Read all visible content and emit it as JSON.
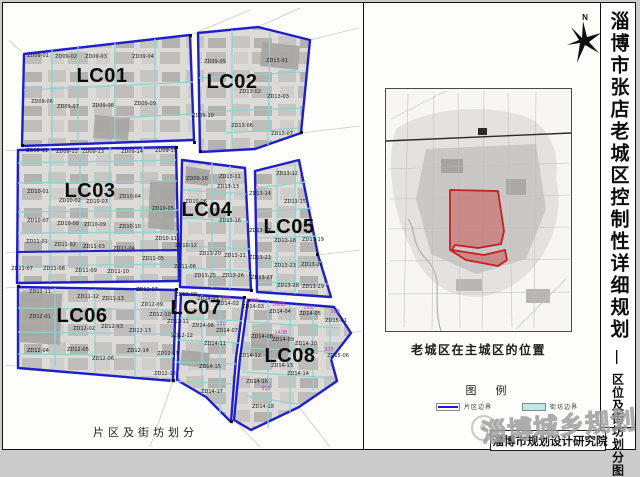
{
  "page": {
    "title_main": "淄博市张店老城区控制性详细规划",
    "title_separator": "—",
    "title_sub": "区位及街坊划分图"
  },
  "north": {
    "label": "N"
  },
  "map_panel": {
    "caption": "片区及街坊划分"
  },
  "locator": {
    "caption": "老城区在主城区的位置"
  },
  "legend": {
    "title": "图 例",
    "items": [
      {
        "label": "片区边界",
        "color": "#2222bb",
        "style": "line"
      },
      {
        "label": "街坊边界",
        "color": "#bfe6e8",
        "style": "fill"
      }
    ]
  },
  "footer": {
    "watermark": "淄博城乡规划",
    "institute": "淄博市规划设计研究院"
  },
  "colors": {
    "district_boundary": "#1f1fc8",
    "block_boundary": "#8fd2d2",
    "parcel_gray": "#c3c2bf",
    "highlight_red": "#c51f1f",
    "plot_code_magenta": "#c438c4",
    "logo_blue": "#2b3f9e"
  },
  "map": {
    "district_labels": [
      {
        "t": "LC01",
        "x": 102,
        "y": 82
      },
      {
        "t": "LC02",
        "x": 232,
        "y": 88
      },
      {
        "t": "LC03",
        "x": 90,
        "y": 197
      },
      {
        "t": "LC04",
        "x": 207,
        "y": 216
      },
      {
        "t": "LC05",
        "x": 289,
        "y": 233
      },
      {
        "t": "LC06",
        "x": 82,
        "y": 322
      },
      {
        "t": "LC07",
        "x": 196,
        "y": 314
      },
      {
        "t": "LC08",
        "x": 290,
        "y": 362
      }
    ],
    "block_labels": [
      {
        "t": "ZD09-01",
        "x": 38,
        "y": 57
      },
      {
        "t": "ZD09-02",
        "x": 66,
        "y": 58
      },
      {
        "t": "ZD09-03",
        "x": 96,
        "y": 58
      },
      {
        "t": "ZD09-04",
        "x": 143,
        "y": 58
      },
      {
        "t": "ZD09-06",
        "x": 42,
        "y": 103
      },
      {
        "t": "ZD09-07",
        "x": 68,
        "y": 108
      },
      {
        "t": "ZD09-08",
        "x": 103,
        "y": 107
      },
      {
        "t": "ZD09-09",
        "x": 145,
        "y": 105
      },
      {
        "t": "ZD09-05",
        "x": 215,
        "y": 63
      },
      {
        "t": "ZD13-01",
        "x": 277,
        "y": 62
      },
      {
        "t": "ZD13-02",
        "x": 250,
        "y": 93
      },
      {
        "t": "ZD13-03",
        "x": 278,
        "y": 98
      },
      {
        "t": "ZD09-10",
        "x": 203,
        "y": 117
      },
      {
        "t": "ZD13-06",
        "x": 242,
        "y": 127
      },
      {
        "t": "ZD13-07",
        "x": 282,
        "y": 135
      },
      {
        "t": "ZD09-11",
        "x": 37,
        "y": 152
      },
      {
        "t": "ZD09-12",
        "x": 67,
        "y": 153
      },
      {
        "t": "ZD09-13",
        "x": 93,
        "y": 153
      },
      {
        "t": "ZD09-14",
        "x": 132,
        "y": 153
      },
      {
        "t": "ZD09-15",
        "x": 166,
        "y": 152
      },
      {
        "t": "ZD09-16",
        "x": 197,
        "y": 180
      },
      {
        "t": "ZD10-01",
        "x": 38,
        "y": 193
      },
      {
        "t": "ZD10-02",
        "x": 70,
        "y": 202
      },
      {
        "t": "ZD10-03",
        "x": 97,
        "y": 203
      },
      {
        "t": "ZD10-04",
        "x": 130,
        "y": 198
      },
      {
        "t": "ZD10-05",
        "x": 163,
        "y": 210
      },
      {
        "t": "ZD10-06",
        "x": 196,
        "y": 203
      },
      {
        "t": "ZD10-07",
        "x": 38,
        "y": 222
      },
      {
        "t": "ZD10-08",
        "x": 68,
        "y": 225
      },
      {
        "t": "ZD10-09",
        "x": 95,
        "y": 226
      },
      {
        "t": "ZD10-10",
        "x": 130,
        "y": 228
      },
      {
        "t": "ZD10-11",
        "x": 166,
        "y": 240
      },
      {
        "t": "ZD10-12",
        "x": 186,
        "y": 247
      },
      {
        "t": "ZD11-01",
        "x": 37,
        "y": 243
      },
      {
        "t": "ZD11-02",
        "x": 65,
        "y": 246
      },
      {
        "t": "ZD11-03",
        "x": 94,
        "y": 248
      },
      {
        "t": "ZD11-04",
        "x": 124,
        "y": 250
      },
      {
        "t": "ZD11-05",
        "x": 153,
        "y": 260
      },
      {
        "t": "ZD11-06",
        "x": 185,
        "y": 268
      },
      {
        "t": "ZD11-07",
        "x": 22,
        "y": 270
      },
      {
        "t": "ZD11-08",
        "x": 54,
        "y": 270
      },
      {
        "t": "ZD11-09",
        "x": 86,
        "y": 272
      },
      {
        "t": "ZD11-10",
        "x": 118,
        "y": 273
      },
      {
        "t": "ZD13-11",
        "x": 230,
        "y": 178
      },
      {
        "t": "ZD13-12",
        "x": 287,
        "y": 175
      },
      {
        "t": "ZD13-13",
        "x": 228,
        "y": 188
      },
      {
        "t": "ZD13-14",
        "x": 260,
        "y": 195
      },
      {
        "t": "ZD13-15",
        "x": 295,
        "y": 203
      },
      {
        "t": "ZD13-16",
        "x": 230,
        "y": 222
      },
      {
        "t": "ZD13-17",
        "x": 260,
        "y": 232
      },
      {
        "t": "ZD13-18",
        "x": 285,
        "y": 242
      },
      {
        "t": "ZD13-19",
        "x": 313,
        "y": 241
      },
      {
        "t": "ZD13-20",
        "x": 210,
        "y": 255
      },
      {
        "t": "ZD13-21",
        "x": 235,
        "y": 257
      },
      {
        "t": "ZD13-22",
        "x": 260,
        "y": 259
      },
      {
        "t": "ZD13-23",
        "x": 285,
        "y": 267
      },
      {
        "t": "ZD13-24",
        "x": 312,
        "y": 266
      },
      {
        "t": "ZD13-25",
        "x": 205,
        "y": 277
      },
      {
        "t": "ZD13-26",
        "x": 233,
        "y": 277
      },
      {
        "t": "ZD13-27",
        "x": 262,
        "y": 279
      },
      {
        "t": "ZD13-28",
        "x": 288,
        "y": 287
      },
      {
        "t": "ZD13-29",
        "x": 313,
        "y": 288
      },
      {
        "t": "ZD11-11",
        "x": 40,
        "y": 293
      },
      {
        "t": "ZD11-12",
        "x": 88,
        "y": 298
      },
      {
        "t": "ZD11-13",
        "x": 113,
        "y": 300
      },
      {
        "t": "ZD12-01",
        "x": 40,
        "y": 318
      },
      {
        "t": "ZD12-02",
        "x": 84,
        "y": 330
      },
      {
        "t": "ZD12-03",
        "x": 112,
        "y": 328
      },
      {
        "t": "ZD12-04",
        "x": 38,
        "y": 352
      },
      {
        "t": "ZD12-05",
        "x": 78,
        "y": 351
      },
      {
        "t": "ZD12-06",
        "x": 103,
        "y": 360
      },
      {
        "t": "ZD12-07",
        "x": 147,
        "y": 291
      },
      {
        "t": "ZD12-08",
        "x": 186,
        "y": 296
      },
      {
        "t": "ZD12-09",
        "x": 152,
        "y": 306
      },
      {
        "t": "ZD12-10",
        "x": 160,
        "y": 316
      },
      {
        "t": "ZD12-11",
        "x": 178,
        "y": 323
      },
      {
        "t": "ZD12-12",
        "x": 182,
        "y": 337
      },
      {
        "t": "ZD12-13",
        "x": 140,
        "y": 332
      },
      {
        "t": "ZD12-14",
        "x": 138,
        "y": 352
      },
      {
        "t": "ZD12-15",
        "x": 168,
        "y": 355
      },
      {
        "t": "ZD12-16",
        "x": 165,
        "y": 375
      },
      {
        "t": "ZD14-01",
        "x": 208,
        "y": 300
      },
      {
        "t": "ZD14-02",
        "x": 228,
        "y": 305
      },
      {
        "t": "ZD14-03",
        "x": 253,
        "y": 308
      },
      {
        "t": "ZD14-04",
        "x": 280,
        "y": 313
      },
      {
        "t": "ZD14-05",
        "x": 310,
        "y": 315
      },
      {
        "t": "ZD14-06",
        "x": 203,
        "y": 327
      },
      {
        "t": "ZD14-07",
        "x": 227,
        "y": 332
      },
      {
        "t": "ZD14-08",
        "x": 262,
        "y": 338
      },
      {
        "t": "ZD14-09",
        "x": 283,
        "y": 341
      },
      {
        "t": "ZD14-10",
        "x": 306,
        "y": 345
      },
      {
        "t": "ZD14-11",
        "x": 215,
        "y": 345
      },
      {
        "t": "ZD14-12",
        "x": 250,
        "y": 357
      },
      {
        "t": "ZD14-13",
        "x": 282,
        "y": 367
      },
      {
        "t": "ZD14-14",
        "x": 298,
        "y": 375
      },
      {
        "t": "ZD14-15",
        "x": 210,
        "y": 368
      },
      {
        "t": "ZD14-16",
        "x": 257,
        "y": 383
      },
      {
        "t": "ZD14-17",
        "x": 212,
        "y": 393
      },
      {
        "t": "ZD14-18",
        "x": 263,
        "y": 408
      },
      {
        "t": "ZD15-01",
        "x": 336,
        "y": 322
      },
      {
        "t": "ZD15-06",
        "x": 338,
        "y": 357
      }
    ],
    "code_labels": [
      {
        "t": "298",
        "x": 226,
        "y": 300
      },
      {
        "t": "298A",
        "x": 252,
        "y": 302
      },
      {
        "t": "298B",
        "x": 279,
        "y": 306
      },
      {
        "t": "299",
        "x": 308,
        "y": 309
      },
      {
        "t": "308",
        "x": 335,
        "y": 313
      },
      {
        "t": "143B",
        "x": 281,
        "y": 334
      },
      {
        "t": "130",
        "x": 221,
        "y": 325
      },
      {
        "t": "335",
        "x": 329,
        "y": 351
      },
      {
        "t": "315",
        "x": 266,
        "y": 390
      }
    ]
  }
}
